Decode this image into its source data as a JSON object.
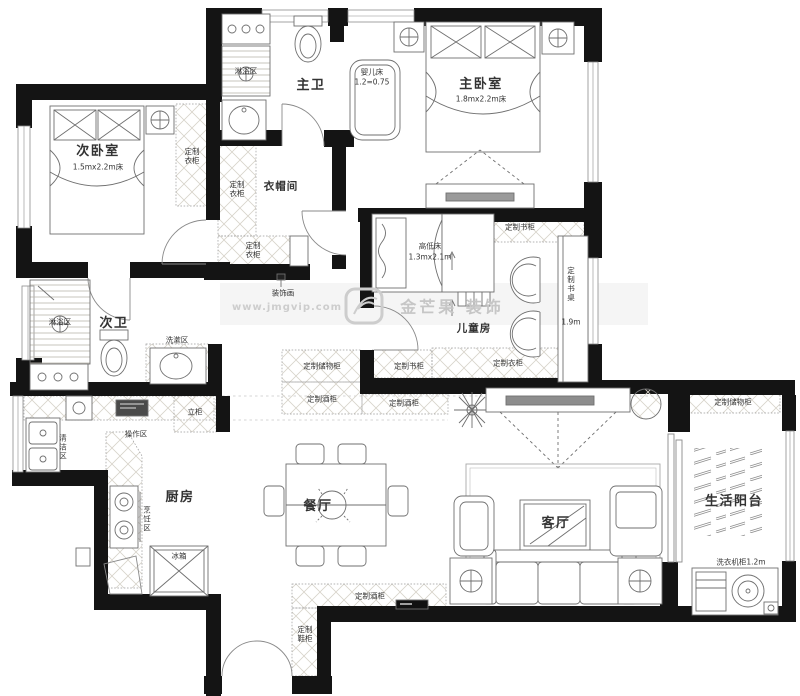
{
  "rooms": {
    "master_bedroom": {
      "name": "主卧室",
      "size": "1.8mx2.2m床"
    },
    "second_bedroom": {
      "name": "次卧室",
      "size": "1.5mx2.2m床"
    },
    "kids_room": {
      "name": "儿童房"
    },
    "master_bath": {
      "name": "主卫"
    },
    "second_bath": {
      "name": "次卫"
    },
    "cloakroom": {
      "name": "衣帽间"
    },
    "kitchen": {
      "name": "厨房"
    },
    "dining": {
      "name": "餐厅"
    },
    "living": {
      "name": "客厅"
    },
    "balcony": {
      "name": "生活阳台"
    }
  },
  "zones": {
    "shower": "淋浴区",
    "wash": "洗漱区",
    "clean": "清洁区",
    "operation": "操作区",
    "cooking": "烹饪区"
  },
  "cabinets": {
    "wardrobe": "定制衣柜",
    "bookcase": "定制书柜",
    "storage": "定制储物柜",
    "wine": "定制酒柜",
    "shoe": "定制鞋柜",
    "tall": "立柜",
    "desk": {
      "name": "定制书桌",
      "size": "1.9m"
    }
  },
  "furniture": {
    "baby_bed": {
      "name": "婴儿床",
      "size": "1.2=0.75"
    },
    "bunk_bed": {
      "name": "高低床",
      "size": "1.3mx2.1m"
    },
    "fridge": "冰箱",
    "washer_cabinet": "洗衣机柜1.2m",
    "decor_painting": "装饰画"
  },
  "watermark": {
    "url": "www.jmgvip.com",
    "brand": "金芒果 装饰"
  }
}
